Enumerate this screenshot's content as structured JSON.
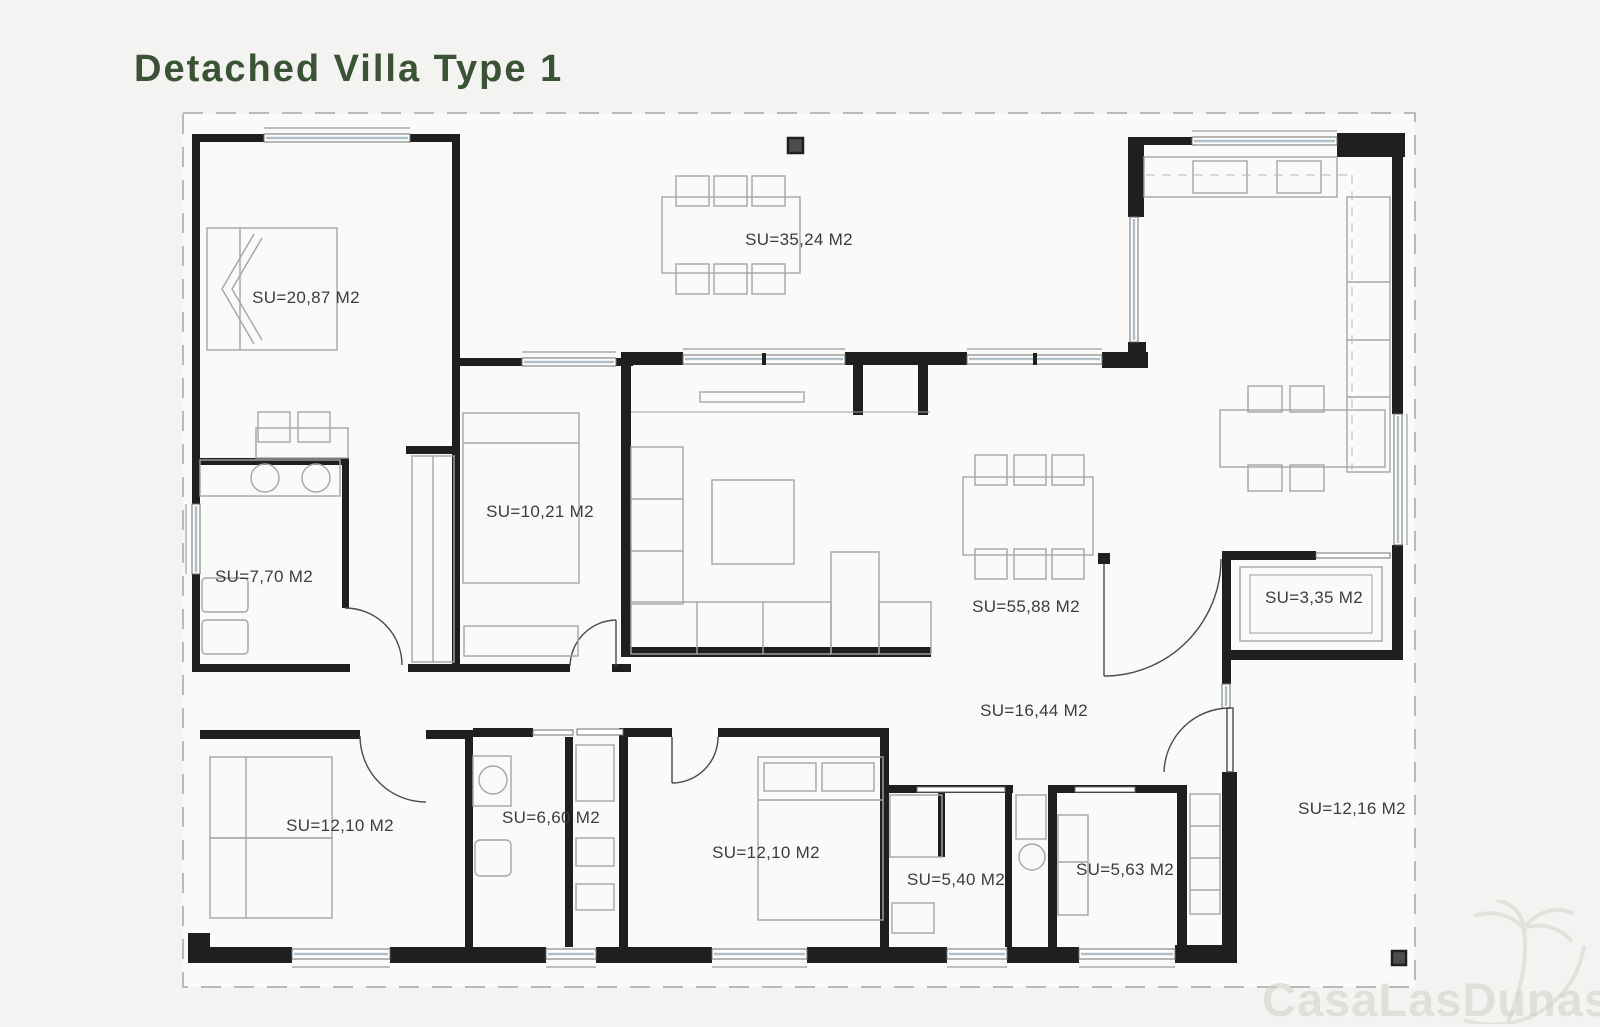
{
  "page": {
    "title": "Detached Villa Type 1",
    "title_color": "#3a5334",
    "background_color": "#f3f3f1"
  },
  "watermark": {
    "text": "CasaLasDunas",
    "icon": "palm-tree-icon"
  },
  "plan": {
    "type": "architectural-floor-plan",
    "area_unit": "M2",
    "rooms": [
      {
        "id": "master-bedroom",
        "label": "SU=20,87 M2",
        "area_m2": "20,87"
      },
      {
        "id": "front-terrace",
        "label": "SU=35,24 M2",
        "area_m2": "35,24"
      },
      {
        "id": "bedroom-2",
        "label": "SU=10,21 M2",
        "area_m2": "10,21"
      },
      {
        "id": "bathroom-1",
        "label": "SU=7,70 M2",
        "area_m2": "7,70"
      },
      {
        "id": "living-dining",
        "label": "SU=55,88 M2",
        "area_m2": "55,88"
      },
      {
        "id": "storage",
        "label": "SU=3,35 M2",
        "area_m2": "3,35"
      },
      {
        "id": "hallway",
        "label": "SU=16,44 M2",
        "area_m2": "16,44"
      },
      {
        "id": "bedroom-3",
        "label": "SU=12,10 M2",
        "area_m2": "12,10"
      },
      {
        "id": "bathroom-2",
        "label": "SU=6,60 M2",
        "area_m2": "6,60"
      },
      {
        "id": "bedroom-4",
        "label": "SU=12,10 M2",
        "area_m2": "12,10"
      },
      {
        "id": "bathroom-3",
        "label": "SU=5,40 M2",
        "area_m2": "5,40"
      },
      {
        "id": "laundry",
        "label": "SU=5,63 M2",
        "area_m2": "5,63"
      },
      {
        "id": "side-terrace",
        "label": "SU=12,16 M2",
        "area_m2": "12,16"
      }
    ]
  }
}
